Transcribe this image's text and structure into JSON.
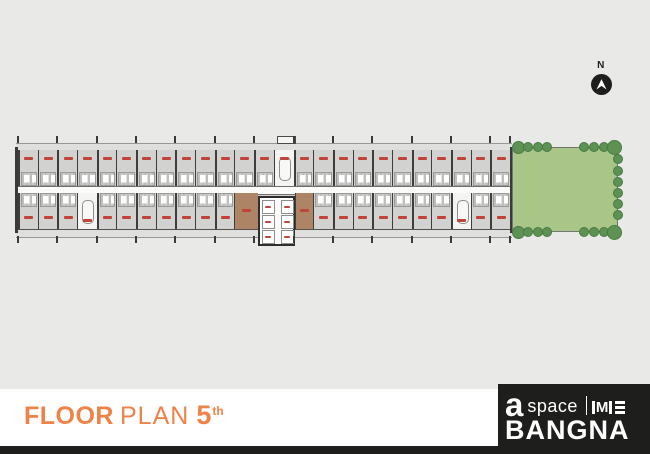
{
  "page": {
    "background_color": "#E9E9E7",
    "type": "floor-plan-poster"
  },
  "compass": {
    "label": "N",
    "circle_color": "#1E1E1C",
    "arrow_color": "#FFFFFF"
  },
  "title": {
    "floor_word": "FLOOR",
    "plan_word": "PLAN",
    "floor_number": "5",
    "floor_suffix": "th",
    "color": "#EE8247"
  },
  "brand": {
    "a": "a",
    "space": "space",
    "me_monogram": "M",
    "project": "BANGNA",
    "box_color": "#1E1E1C",
    "text_color": "#FFFFFF"
  },
  "floor_plan": {
    "wall_color": "#3A3A38",
    "unit_fill": "#D2D2D0",
    "stair_fill": "#F4F4F3",
    "corridor_color": "#FBFBFA",
    "core_color": "#AE8466",
    "unit_label_color": "#C0443A",
    "unit_labels_legible": false,
    "rows": {
      "top": {
        "unit_count": 25,
        "stair_slots": [
          13
        ]
      },
      "bottom": {
        "unit_count": 25,
        "stair_slots": [
          3,
          22
        ],
        "core_start": 11,
        "core_span": 4
      }
    },
    "elevators": {
      "columns": 2,
      "cells_per_column": 3
    }
  },
  "garden": {
    "fill": "#A9C688",
    "tree_fill": "#5E9254",
    "tree_edge": "#477A41",
    "trees": {
      "top_left": 4,
      "top_right": 4,
      "bottom_left": 4,
      "bottom_right": 4,
      "right_side": 6
    }
  }
}
